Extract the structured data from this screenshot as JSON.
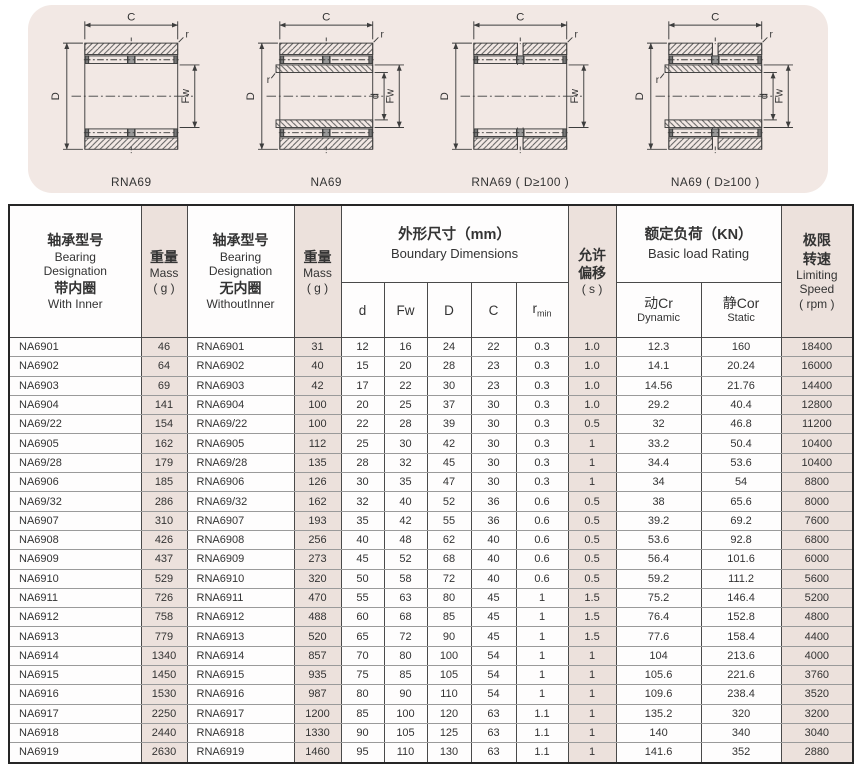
{
  "colors": {
    "banner_pink": "#f2e8e4",
    "accent_pink": "#ece1dc",
    "line": "#3d3d3d",
    "text": "#333333"
  },
  "diagrams": {
    "dim_labels": {
      "C": "C",
      "D": "D",
      "Fw": "Fw",
      "d": "d",
      "r": "r"
    },
    "items": [
      {
        "caption": "RNA69",
        "inner_ring": false,
        "double_row": false
      },
      {
        "caption": "NA69",
        "inner_ring": true,
        "double_row": false
      },
      {
        "caption": "RNA69 ( D≥100 )",
        "inner_ring": false,
        "double_row": true
      },
      {
        "caption": "NA69 ( D≥100 )",
        "inner_ring": true,
        "double_row": true
      }
    ]
  },
  "table": {
    "header": {
      "na": [
        "轴承型号",
        "Bearing",
        "Designation",
        "带内圈",
        "With Inner"
      ],
      "mass": [
        "重量",
        "Mass",
        "( g )"
      ],
      "rna": [
        "轴承型号",
        "Bearing",
        "Designation",
        "无内圈",
        "WithoutInner"
      ],
      "mass2": [
        "重量",
        "Mass",
        "( g )"
      ],
      "boundary": [
        "外形尺寸（mm）",
        "Boundary Dimensions"
      ],
      "sub": {
        "d": "d",
        "fw": "Fw",
        "D": "D",
        "C": "C",
        "r": "r",
        "r_sub": "min"
      },
      "offset": [
        "允许",
        "偏移",
        "( s )"
      ],
      "load": [
        "额定负荷（KN）",
        "Basic load Rating"
      ],
      "dynamic": [
        "动Cr",
        "Dynamic"
      ],
      "static": [
        "静Cor",
        "Static"
      ],
      "speed": [
        "极限",
        "转速",
        "Limiting",
        "Speed",
        "( rpm )"
      ]
    },
    "columns": [
      {
        "key": "na",
        "pink": false,
        "align": "left"
      },
      {
        "key": "mass-with",
        "pink": true
      },
      {
        "key": "rna",
        "pink": false,
        "align": "left"
      },
      {
        "key": "mass-without",
        "pink": true
      },
      {
        "key": "d",
        "pink": false
      },
      {
        "key": "fw",
        "pink": false
      },
      {
        "key": "outer-d",
        "pink": false
      },
      {
        "key": "width-c",
        "pink": false
      },
      {
        "key": "rmin",
        "pink": false
      },
      {
        "key": "offset-s",
        "pink": true
      },
      {
        "key": "dynamic-cr",
        "pink": false
      },
      {
        "key": "static-cor",
        "pink": false
      },
      {
        "key": "speed-rpm",
        "pink": true
      }
    ],
    "rows": [
      [
        "NA6901",
        "46",
        "RNA6901",
        "31",
        "12",
        "16",
        "24",
        "22",
        "0.3",
        "1.0",
        "12.3",
        "160",
        "18400"
      ],
      [
        "NA6902",
        "64",
        "RNA6902",
        "40",
        "15",
        "20",
        "28",
        "23",
        "0.3",
        "1.0",
        "14.1",
        "20.24",
        "16000"
      ],
      [
        "NA6903",
        "69",
        "RNA6903",
        "42",
        "17",
        "22",
        "30",
        "23",
        "0.3",
        "1.0",
        "14.56",
        "21.76",
        "14400"
      ],
      [
        "NA6904",
        "141",
        "RNA6904",
        "100",
        "20",
        "25",
        "37",
        "30",
        "0.3",
        "1.0",
        "29.2",
        "40.4",
        "12800"
      ],
      [
        "NA69/22",
        "154",
        "RNA69/22",
        "100",
        "22",
        "28",
        "39",
        "30",
        "0.3",
        "0.5",
        "32",
        "46.8",
        "11200"
      ],
      [
        "NA6905",
        "162",
        "RNA6905",
        "112",
        "25",
        "30",
        "42",
        "30",
        "0.3",
        "1",
        "33.2",
        "50.4",
        "10400"
      ],
      [
        "NA69/28",
        "179",
        "RNA69/28",
        "135",
        "28",
        "32",
        "45",
        "30",
        "0.3",
        "1",
        "34.4",
        "53.6",
        "10400"
      ],
      [
        "NA6906",
        "185",
        "RNA6906",
        "126",
        "30",
        "35",
        "47",
        "30",
        "0.3",
        "1",
        "34",
        "54",
        "8800"
      ],
      [
        "NA69/32",
        "286",
        "RNA69/32",
        "162",
        "32",
        "40",
        "52",
        "36",
        "0.6",
        "0.5",
        "38",
        "65.6",
        "8000"
      ],
      [
        "NA6907",
        "310",
        "RNA6907",
        "193",
        "35",
        "42",
        "55",
        "36",
        "0.6",
        "0.5",
        "39.2",
        "69.2",
        "7600"
      ],
      [
        "NA6908",
        "426",
        "RNA6908",
        "256",
        "40",
        "48",
        "62",
        "40",
        "0.6",
        "0.5",
        "53.6",
        "92.8",
        "6800"
      ],
      [
        "NA6909",
        "437",
        "RNA6909",
        "273",
        "45",
        "52",
        "68",
        "40",
        "0.6",
        "0.5",
        "56.4",
        "101.6",
        "6000"
      ],
      [
        "NA6910",
        "529",
        "RNA6910",
        "320",
        "50",
        "58",
        "72",
        "40",
        "0.6",
        "0.5",
        "59.2",
        "111.2",
        "5600"
      ],
      [
        "NA6911",
        "726",
        "RNA6911",
        "470",
        "55",
        "63",
        "80",
        "45",
        "1",
        "1.5",
        "75.2",
        "146.4",
        "5200"
      ],
      [
        "NA6912",
        "758",
        "RNA6912",
        "488",
        "60",
        "68",
        "85",
        "45",
        "1",
        "1.5",
        "76.4",
        "152.8",
        "4800"
      ],
      [
        "NA6913",
        "779",
        "RNA6913",
        "520",
        "65",
        "72",
        "90",
        "45",
        "1",
        "1.5",
        "77.6",
        "158.4",
        "4400"
      ],
      [
        "NA6914",
        "1340",
        "RNA6914",
        "857",
        "70",
        "80",
        "100",
        "54",
        "1",
        "1",
        "104",
        "213.6",
        "4000"
      ],
      [
        "NA6915",
        "1450",
        "RNA6915",
        "935",
        "75",
        "85",
        "105",
        "54",
        "1",
        "1",
        "105.6",
        "221.6",
        "3760"
      ],
      [
        "NA6916",
        "1530",
        "RNA6916",
        "987",
        "80",
        "90",
        "110",
        "54",
        "1",
        "1",
        "109.6",
        "238.4",
        "3520"
      ],
      [
        "NA6917",
        "2250",
        "RNA6917",
        "1200",
        "85",
        "100",
        "120",
        "63",
        "1.1",
        "1",
        "135.2",
        "320",
        "3200"
      ],
      [
        "NA6918",
        "2440",
        "RNA6918",
        "1330",
        "90",
        "105",
        "125",
        "63",
        "1.1",
        "1",
        "140",
        "340",
        "3040"
      ],
      [
        "NA6919",
        "2630",
        "RNA6919",
        "1460",
        "95",
        "110",
        "130",
        "63",
        "1.1",
        "1",
        "141.6",
        "352",
        "2880"
      ]
    ]
  }
}
